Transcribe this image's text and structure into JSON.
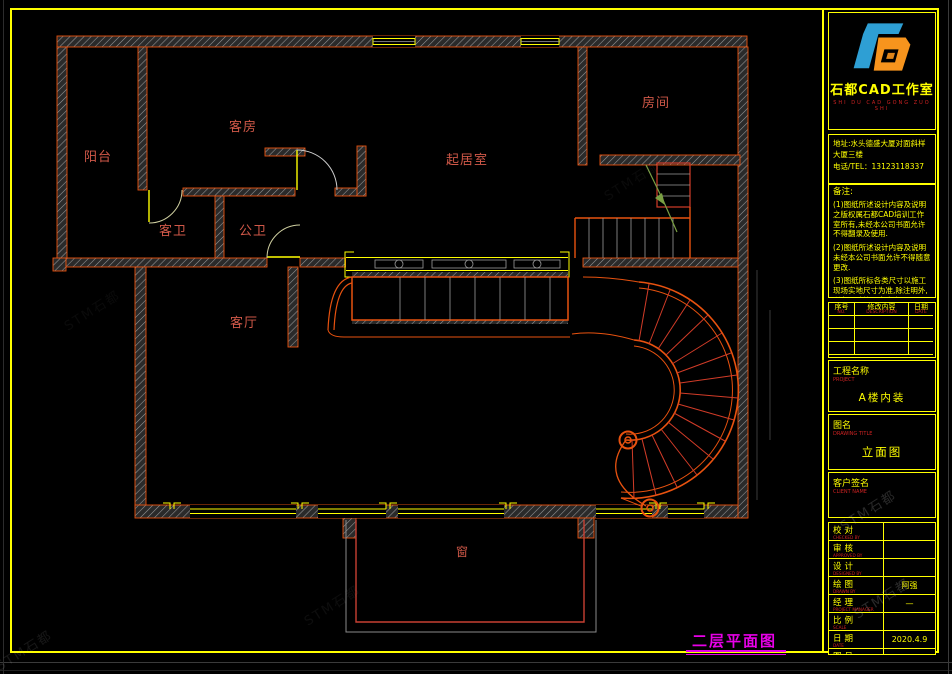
{
  "colors": {
    "frame": "#ffff00",
    "wall_edge": "#e8520f",
    "label_red": "#d05848",
    "plan_title": "#e800e8",
    "logo_blue": "#2e9fd4",
    "logo_orange": "#f7941d"
  },
  "plan": {
    "rooms": [
      {
        "id": "balcony",
        "label": "阳台"
      },
      {
        "id": "guest-room",
        "label": "客房"
      },
      {
        "id": "living-room",
        "label": "起居室"
      },
      {
        "id": "room",
        "label": "房间"
      },
      {
        "id": "guest-bath",
        "label": "客卫"
      },
      {
        "id": "public-bath",
        "label": "公卫"
      },
      {
        "id": "parlor",
        "label": "客厅"
      },
      {
        "id": "window",
        "label": "窗"
      }
    ],
    "title": "二层平面图"
  },
  "title_block": {
    "logo": {
      "company": "石都CAD工作室",
      "pinyin": "SHI DU CAD GONG ZUO SHI"
    },
    "address": {
      "line1": "地址:水头德盛大厦对面斜样",
      "line2": "大厦三楼",
      "line3": "电话/TEL：13123118337"
    },
    "notes": {
      "title": "备注:",
      "items": [
        "(1)图纸所述设计内容及说明之版权属石都CAD培训工作室所有,未经本公司书面允许不得翻录及使用.",
        "(2)图纸所述设计内容及说明未经本公司书面允许不得随意更改.",
        "(3)图纸所标各类尺寸以施工现场实地尺寸为准,除注明外,所有尺寸均以毫米表示."
      ]
    },
    "revision": {
      "headers": [
        {
          "zh": "序号",
          "en": "NO."
        },
        {
          "zh": "修改内容",
          "en": "DESCRIPTION"
        },
        {
          "zh": "日期",
          "en": "DATE"
        }
      ]
    },
    "project": {
      "zh": "工程名称",
      "en": "PROJECT",
      "value": "A楼内装"
    },
    "drawing": {
      "zh": "图名",
      "en": "DRAWING TITLE",
      "value": "立面图"
    },
    "client": {
      "zh": "客户签名",
      "en": "CLIENT NAME",
      "value": ""
    },
    "info_rows": [
      {
        "zh": "校对",
        "en": "CHECKED BY",
        "value": ""
      },
      {
        "zh": "审核",
        "en": "APPROVED BY",
        "value": ""
      },
      {
        "zh": "设计",
        "en": "DESIGNED BY",
        "value": ""
      },
      {
        "zh": "绘图",
        "en": "DRAWN BY",
        "value": "阿强"
      },
      {
        "zh": "经理",
        "en": "PROJECT MANAGER",
        "value": "—"
      },
      {
        "zh": "比例",
        "en": "SCALE",
        "value": ""
      },
      {
        "zh": "日期",
        "en": "DATE",
        "value": "2020.4.9"
      },
      {
        "zh": "图号",
        "en": "DRAWING No",
        "value": "SD-05"
      }
    ]
  },
  "watermark": {
    "text": "STM石都"
  }
}
